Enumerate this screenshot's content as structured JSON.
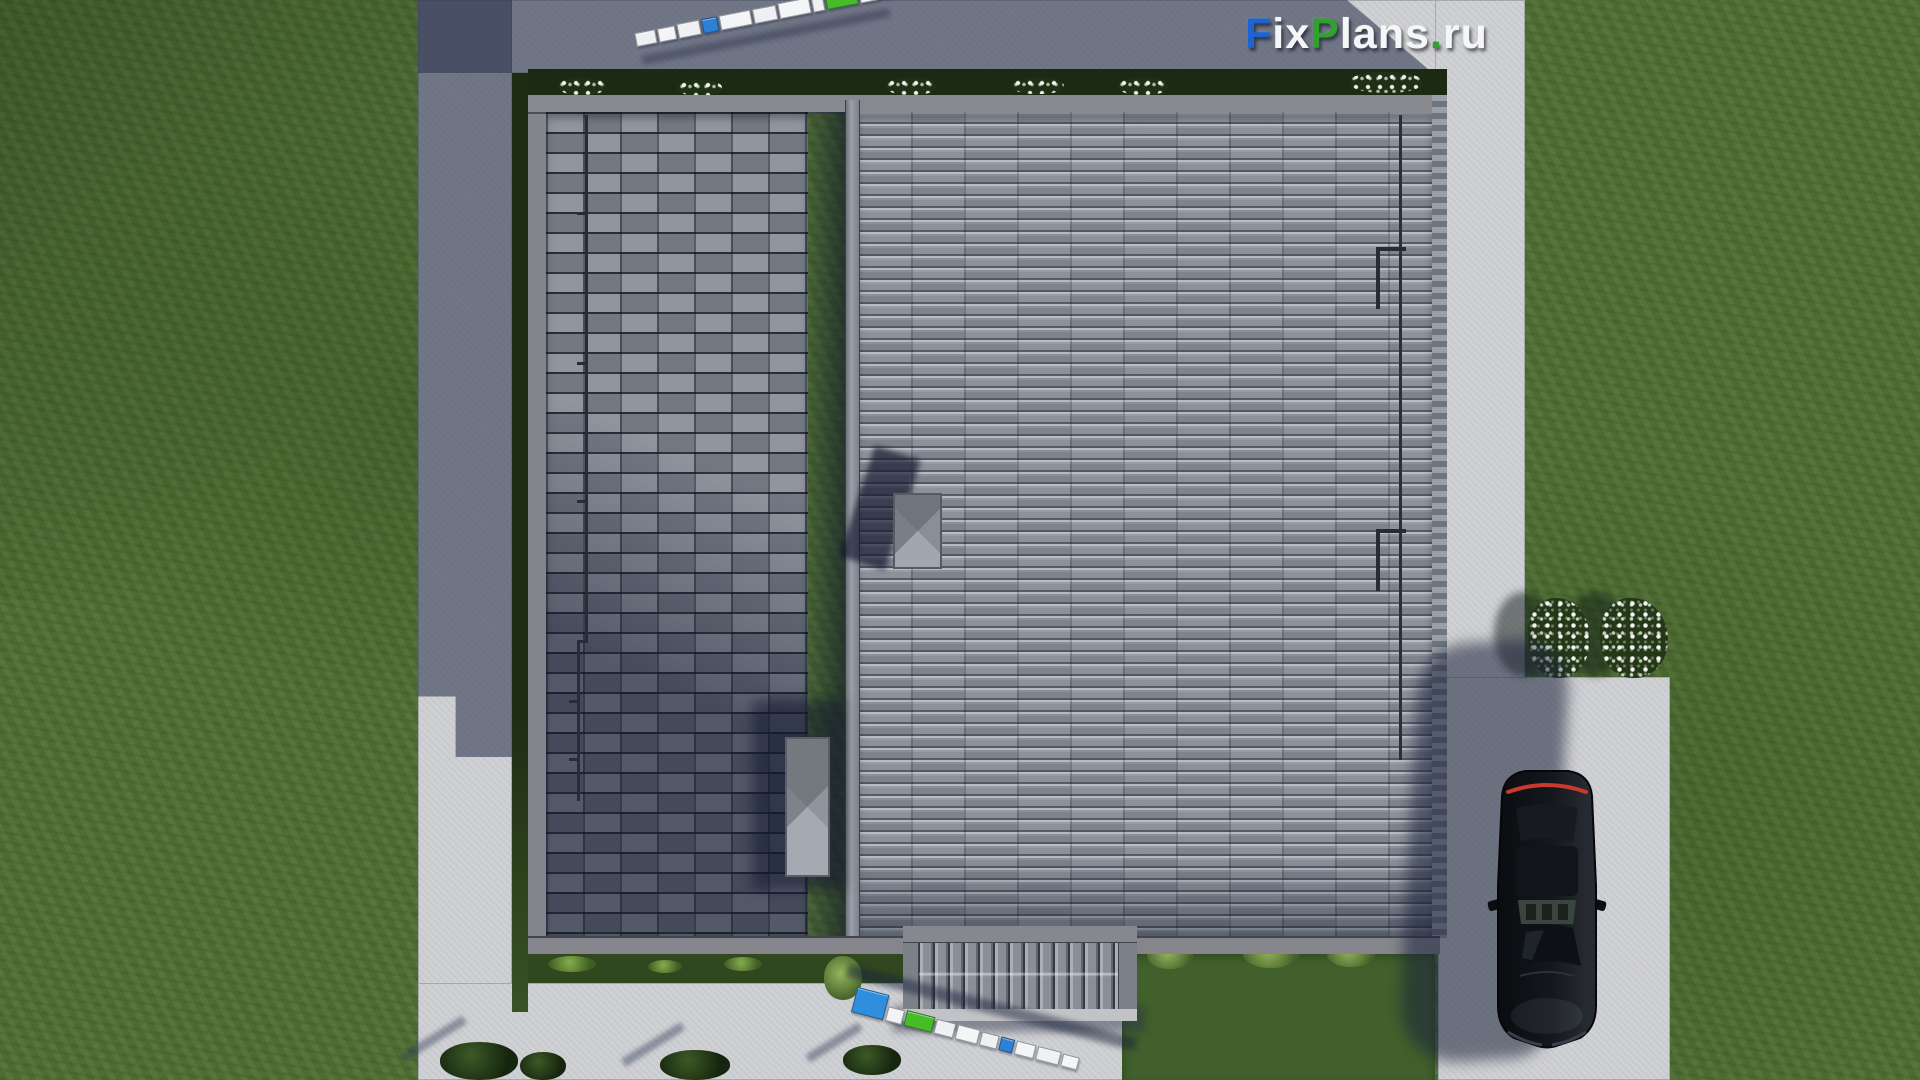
{
  "watermark": {
    "full_text": "FixPlans.ru",
    "parts": [
      {
        "text": "F",
        "style": "color:#1e63d3"
      },
      {
        "text": "ix",
        "style": "color:#f5f6f8"
      },
      {
        "text": "P",
        "style": "color:#2ea12e"
      },
      {
        "text": "lans",
        "style": "color:#f5f6f8"
      },
      {
        "text": ".",
        "style": "color:#2ea12e"
      },
      {
        "text": "ru",
        "style": "color:#f5f6f8"
      }
    ]
  },
  "palette": {
    "grass": "#55743a",
    "grass_shadowed": "#2c3f1e",
    "concrete_path": "#cfd0d3",
    "cast_shadow": "#2c3550",
    "roof_left_plane": "#848a94",
    "roof_right_plane": "#8d939c",
    "roof_ridge_shadow": "#202a44",
    "eave_trim": "#85888e",
    "hedge": "#1c2913",
    "ruler_white": "#f2f3f4",
    "ruler_blue": "#2e7fd6",
    "ruler_green": "#46bc28",
    "car_body": "#101317",
    "car_taillight": "#c93a2e",
    "flowers": "#ffffff"
  },
  "objects": {
    "house_roof": "dual-plane gray tiled roof, vertical ridge, two chimneys",
    "entrance_canopy": "ribbed slat canopy over entrance, bottom center",
    "car": "black sedan, top view, parked on right driveway",
    "rulers": "two measuring scale sticks (white/blue/green segments)",
    "vegetation": "lawn, hedges, white flower bushes"
  },
  "rulers": {
    "top": {
      "segments": [
        {
          "css": "width:19px;height:12px;background:#eef0f2"
        },
        {
          "css": "width:16px;height:12px;background:#f4f5f7"
        },
        {
          "css": "width:21px;height:13px;background:#eef0f2"
        },
        {
          "css": "width:14px;height:13px;background:#2e7fd6"
        },
        {
          "css": "width:30px;height:13px;background:#f4f5f7"
        },
        {
          "css": "width:22px;height:13px;background:#eef0f2"
        },
        {
          "css": "width:30px;height:14px;background:#f4f5f7"
        },
        {
          "css": "width:10px;height:13px;background:#eef0f2"
        },
        {
          "css": "width:30px;height:15px;background:#46bc28"
        },
        {
          "css": "width:20px;height:14px;background:#f4f5f7"
        },
        {
          "css": "width:19px;height:14px;background:#eef0f2"
        },
        {
          "css": "width:13px;height:15px;background:#46bc28"
        },
        {
          "css": "width:27px;height:25px;background:#2e7fd6"
        }
      ]
    },
    "bottom": {
      "segments": [
        {
          "css": "width:31px;height:24px;background:#2f8fdd"
        },
        {
          "css": "width:15px;height:13px;background:#f2f3f5"
        },
        {
          "css": "width:27px;height:14px;background:#46bc28"
        },
        {
          "css": "width:18px;height:13px;background:#eef0f2"
        },
        {
          "css": "width:21px;height:13px;background:#f4f5f7"
        },
        {
          "css": "width:16px;height:12px;background:#eef0f2"
        },
        {
          "css": "width:12px;height:12px;background:#2e7fd6"
        },
        {
          "css": "width:18px;height:12px;background:#f4f5f7"
        },
        {
          "css": "width:22px;height:12px;background:#eef0f2"
        },
        {
          "css": "width:15px;height:11px;background:#f4f5f7"
        }
      ]
    }
  }
}
